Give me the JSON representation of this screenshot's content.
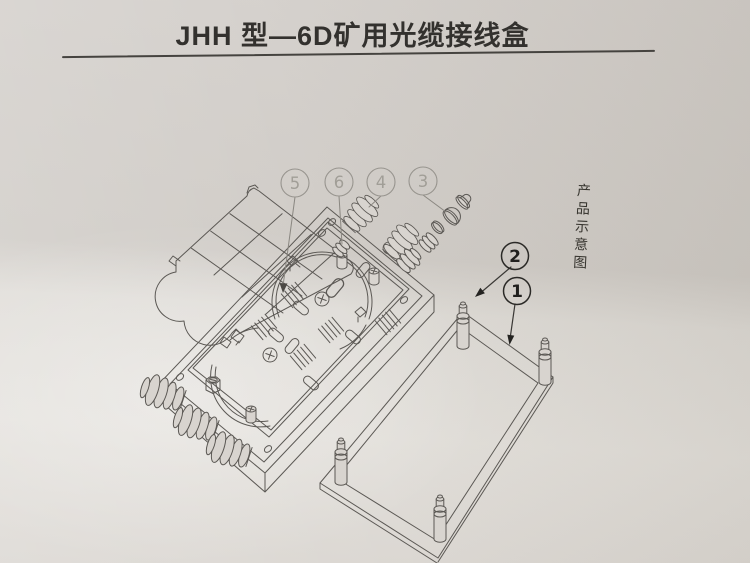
{
  "title": "JHH 型—6D矿用光缆接线盒",
  "side_caption": "产品示意图",
  "callouts": [
    {
      "label": "1"
    },
    {
      "label": "2"
    },
    {
      "label": "3"
    },
    {
      "label": "4"
    },
    {
      "label": "5"
    },
    {
      "label": "6"
    }
  ],
  "colors": {
    "paper": "#d8d4cf",
    "ink": "#5b5854",
    "ink_dark": "#45433f",
    "callout_light": "#a19e97",
    "callout_dark": "#201f1d"
  }
}
